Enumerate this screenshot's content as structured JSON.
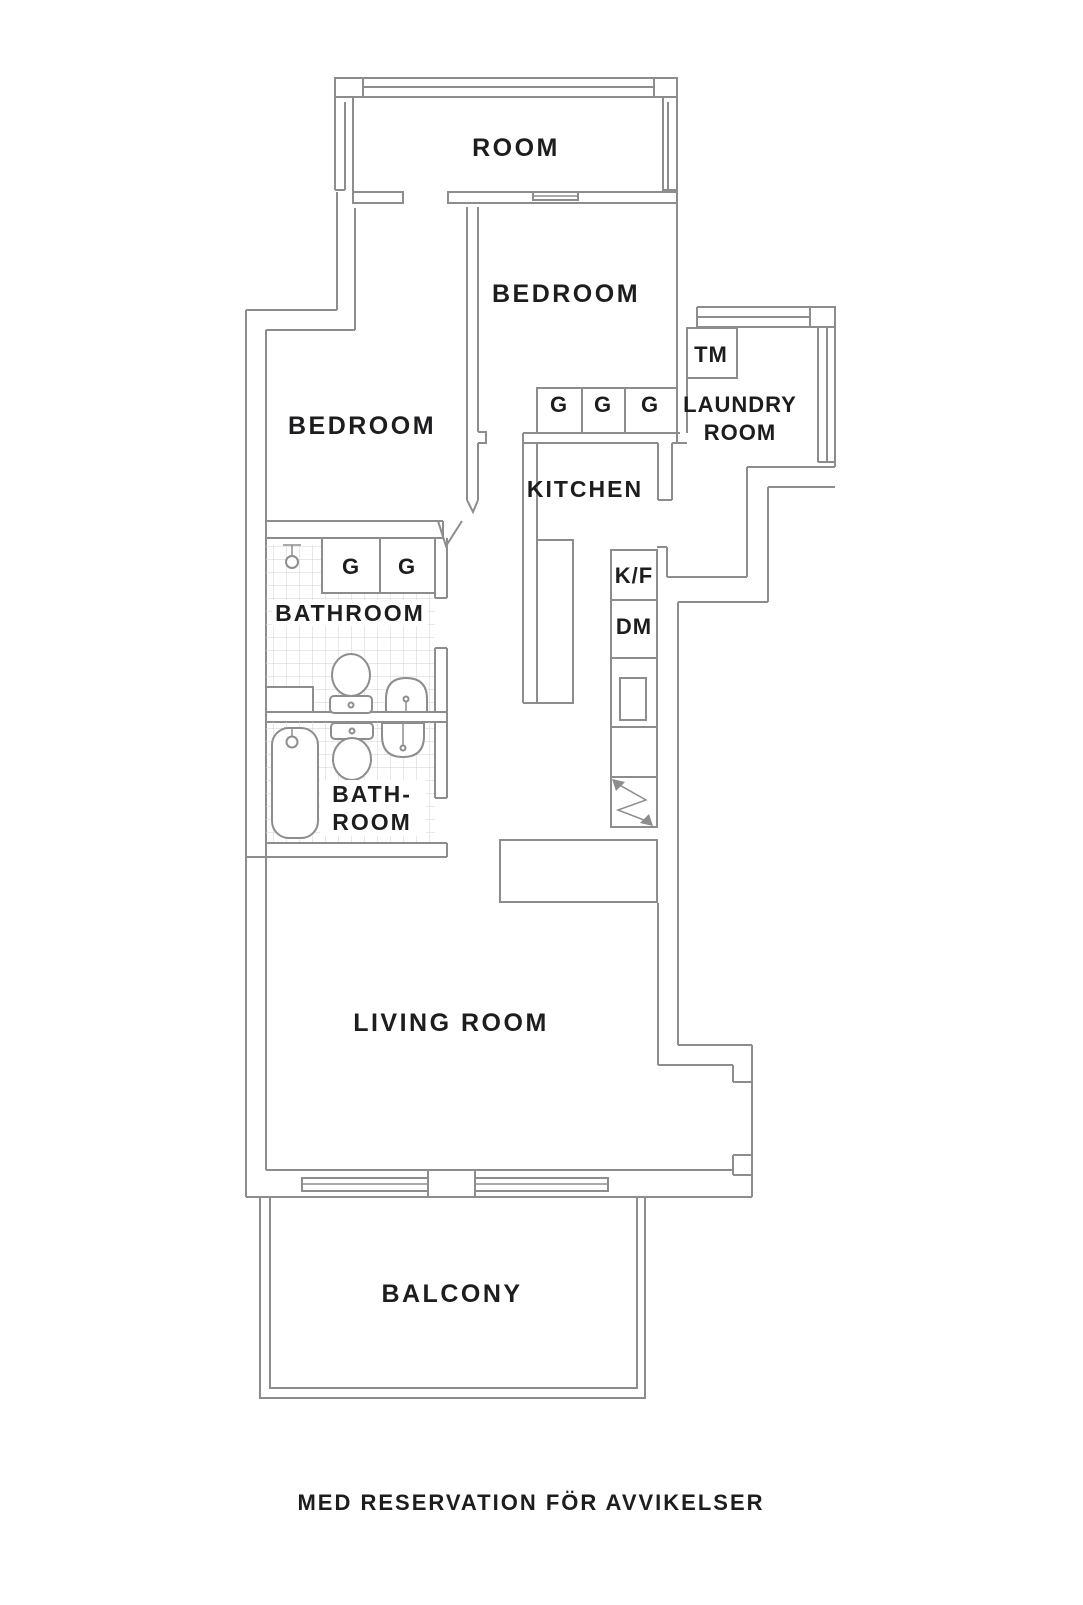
{
  "title": "apartment-floor-plan",
  "colors": {
    "background": "#ffffff",
    "wall_line": "#8d8d8d",
    "tile_line": "#d9d9d9",
    "text": "#1d1d1f"
  },
  "labels": {
    "room_top": "ROOM",
    "bedroom_right": "BEDROOM",
    "bedroom_left": "BEDROOM",
    "laundry_line1": "LAUNDRY",
    "laundry_line2": "ROOM",
    "kitchen": "KITCHEN",
    "bathroom_main": "BATHROOM",
    "bathroom_small_line1": "BATH-",
    "bathroom_small_line2": "ROOM",
    "living_room": "LIVING ROOM",
    "balcony": "BALCONY"
  },
  "appliances": {
    "washing_machine": "TM",
    "fridge_freezer": "K/F",
    "dishwasher": "DM",
    "wardrobe": "G"
  },
  "footer": {
    "disclaimer": "MED RESERVATION FÖR AVVIKELSER"
  }
}
